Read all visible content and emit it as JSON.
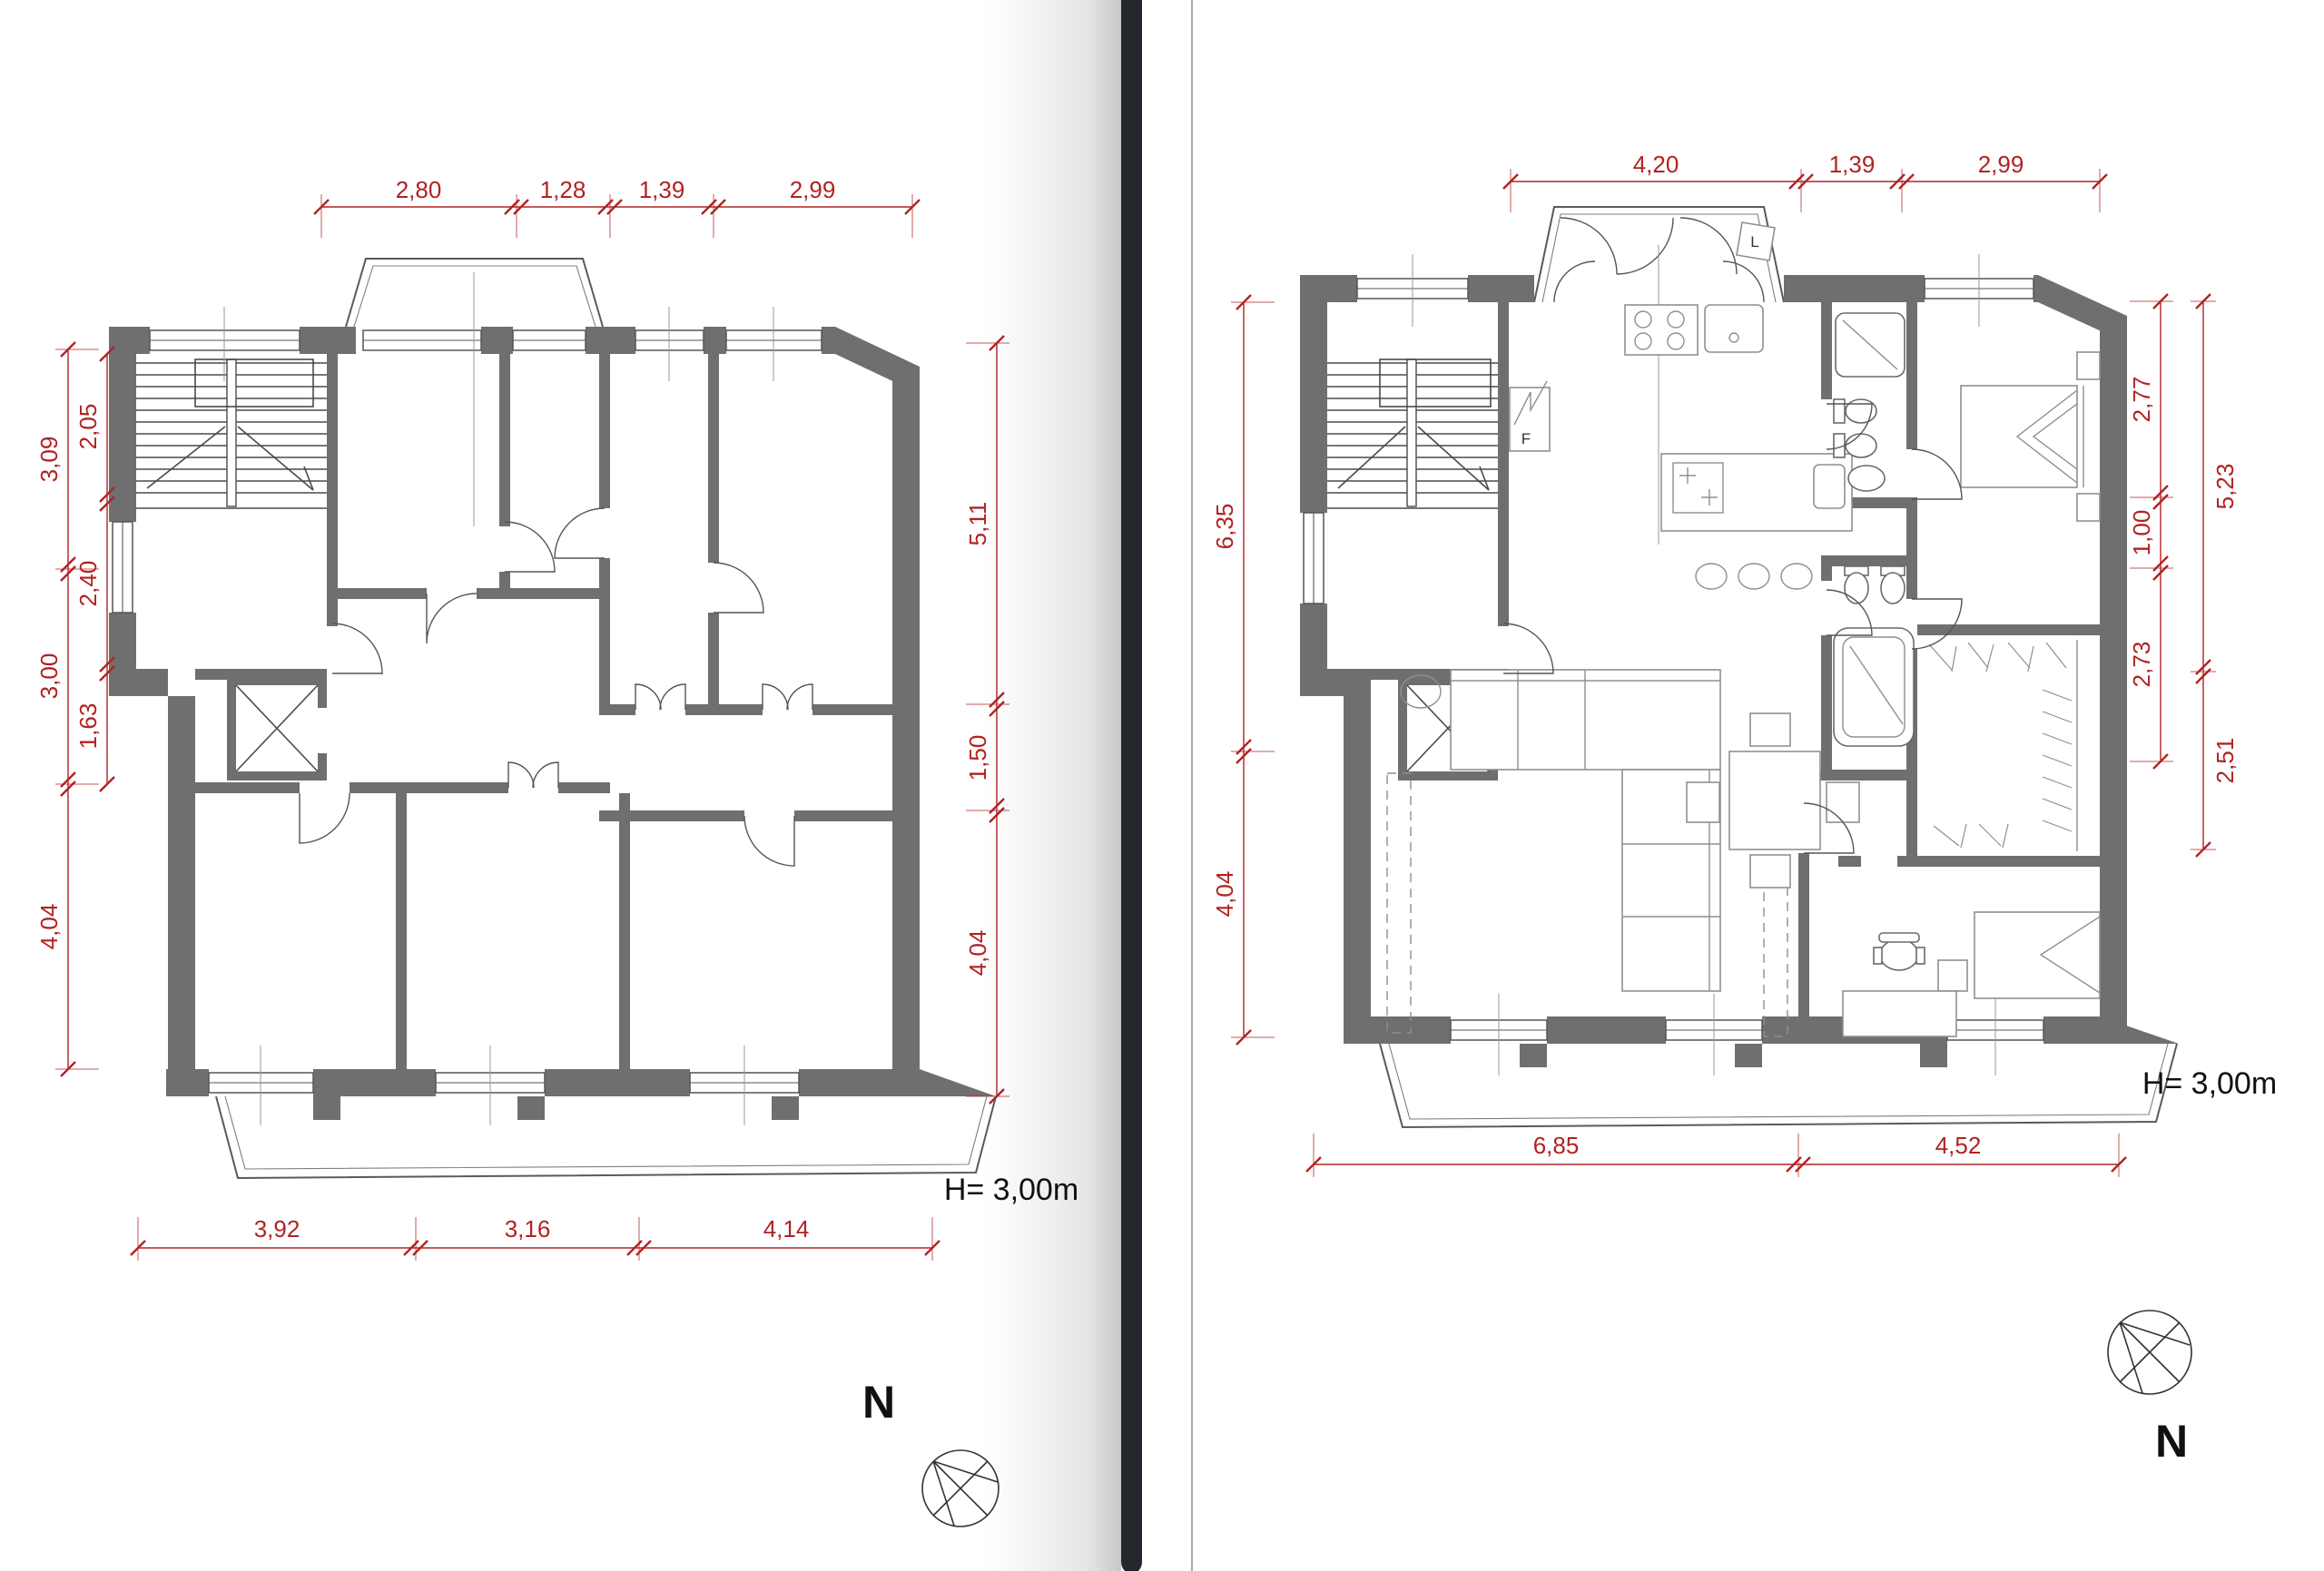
{
  "page": {
    "type": "floor-plan-comparison",
    "colors": {
      "wall": "#6f6f6f",
      "dimension_red": "#b22222",
      "divider_bar": "#23272c",
      "page_edge_line": "#8f8f8f",
      "text": "#111111",
      "background": "#ffffff"
    }
  },
  "divider": {
    "style": "before-after slider bar with page shadow"
  },
  "left_plan": {
    "name": "existing floor plan",
    "dims_top": [
      "2,80",
      "1,28",
      "1,39",
      "2,99"
    ],
    "dims_left_outer": [
      "3,09",
      "3,00",
      "4,04"
    ],
    "dims_left_inner": [
      "2,05",
      "2,40",
      "1,63"
    ],
    "dims_right": [
      "5,11",
      "1,50",
      "4,04"
    ],
    "dims_bottom": [
      "3,92",
      "3,16",
      "4,14"
    ],
    "height_label": "H= 3,00m",
    "compass_label": "N"
  },
  "right_plan": {
    "name": "renovated furnished floor plan",
    "dims_top": [
      "4,20",
      "1,39",
      "2,99"
    ],
    "dims_left": [
      "6,35",
      "4,04"
    ],
    "dims_right_inner": [
      "2,77",
      "1,00",
      "2,73"
    ],
    "dims_right_outer": [
      "5,23",
      "2,51"
    ],
    "dims_bottom": [
      "6,85",
      "4,52"
    ],
    "height_label": "H= 3,00m",
    "compass_label": "N",
    "fridge_label": "F",
    "bay_cabinet_label": "L"
  }
}
